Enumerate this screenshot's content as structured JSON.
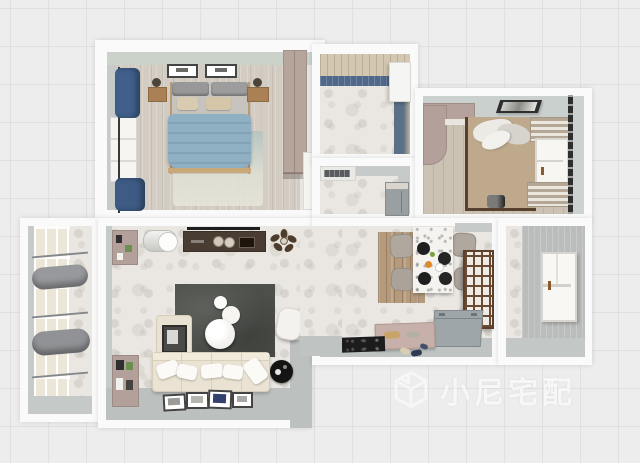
{
  "scene": {
    "type": "3d-floorplan-top-view-render",
    "rooms": [
      {
        "id": "master-bedroom",
        "furniture": [
          "double-bed-blue-duvet",
          "headboard-cushions",
          "pillows",
          "nightstand-left",
          "nightstand-right",
          "plant-left",
          "plant-right",
          "wardrobe",
          "area-rug",
          "window",
          "curtains-blue",
          "wall-frames",
          "door"
        ]
      },
      {
        "id": "bathroom",
        "furniture": [
          "blue-wall-tiles",
          "slatted-ceiling",
          "marble-floor",
          "door"
        ]
      },
      {
        "id": "kitchen-pass",
        "furniture": [
          "vent-unit",
          "steel-cabinet",
          "marble-floor"
        ]
      },
      {
        "id": "second-bedroom",
        "furniture": [
          "desk-cabinet",
          "plant",
          "tatami-rug",
          "bedding-pile",
          "floor-pillow",
          "wall-picture",
          "roman-shade-top",
          "roman-shade-bottom",
          "window",
          "blind-track"
        ]
      },
      {
        "id": "balcony",
        "furniture": [
          "window-wall",
          "curtain-bundle-top",
          "curtain-bundle-bottom",
          "curtain-rails"
        ]
      },
      {
        "id": "living-room",
        "furniture": [
          "tv",
          "tv-console",
          "decor-plates",
          "ceiling-fan",
          "storage-cylinder",
          "bookshelf-top",
          "bookshelf-bottom",
          "charcoal-rug",
          "nesting-table-large",
          "nesting-table-medium",
          "nesting-table-small",
          "sofa",
          "sofa-pillows",
          "chaise",
          "leaning-frame",
          "armchair",
          "black-side-table",
          "floor-frames"
        ]
      },
      {
        "id": "dining-entry",
        "furniture": [
          "dining-table",
          "dining-chairs",
          "plates",
          "fruit",
          "wood-rug",
          "lattice-screen",
          "entry-bench-pink",
          "storage-chest-gray",
          "doormat",
          "shoes"
        ]
      },
      {
        "id": "side-room",
        "furniture": [
          "window",
          "striped-wallpaper"
        ]
      }
    ],
    "watermark": {
      "text": "小尼宅配",
      "logo": "isometric-cube-logo"
    },
    "palette": {
      "canvas_grid_bg": "#ededed",
      "grid_line": "#e0e0e0",
      "wall_outer_white": "#fafafa",
      "wall_inner_gray": "#c6cbca",
      "bedroom_wall_sage": "#cbd2ca",
      "curtain_blue": "#40608b",
      "duvet_blue": "#8fafc2",
      "wood_floor": "#d3ccc3",
      "wardrobe_mauve": "#b6a59b",
      "bath_tile_blue": "#50688a",
      "marble_floor": "#eae7e2",
      "living_rug_charcoal": "#4c4f4a",
      "sofa_cream": "#eae3d3",
      "tv_console_brown": "#493c32",
      "dining_chair_taupe": "#b0a79e",
      "lattice_brown": "#6b4a33",
      "entry_floor_gray": "#bfc4c2",
      "bench_pink": "#c7b0a9",
      "storage_gray": "#9fa6a9",
      "tatami_tan": "#bfa98c",
      "fruit_orange": "#e08a2e",
      "watermark_white": "#ffffff"
    }
  }
}
